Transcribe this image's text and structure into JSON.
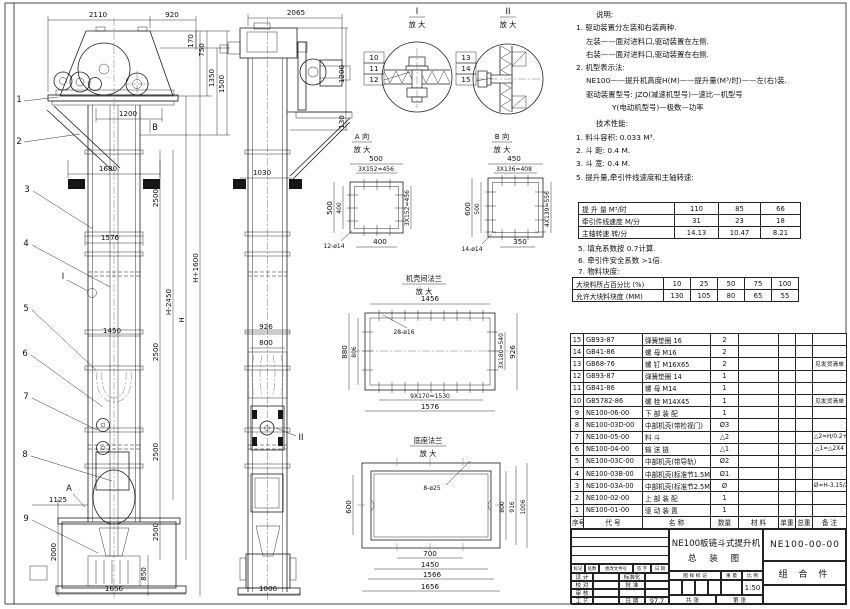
{
  "front": {
    "balloons": [
      "1",
      "2",
      "3",
      "4",
      "5",
      "6",
      "7",
      "8",
      "9"
    ],
    "detail_mark": "I",
    "arrow_a": "A",
    "arrow_b": "B",
    "d": {
      "w2110": "2110",
      "w920": "920",
      "v170": "170",
      "v750": "750",
      "v1350": "1350",
      "v1500": "1500",
      "w1200": "1200",
      "w1680": "1680",
      "p2500": "2500",
      "w1576": "1576",
      "hp": "H+1600",
      "hm": "H-2450",
      "h": "H",
      "w1450": "1450",
      "w1125": "1125",
      "v2000": "2000",
      "v850": "850",
      "w1656": "1656"
    }
  },
  "side": {
    "detail_mark": "II",
    "d": {
      "w2065": "2065",
      "v1200": "1200",
      "v130": "130",
      "w1030": "1030",
      "w926": "926",
      "w800": "800",
      "w1006": "1006"
    }
  },
  "details": {
    "i": {
      "title": "I",
      "sub": "放 大",
      "callouts": [
        "10",
        "11",
        "12"
      ]
    },
    "ii": {
      "title": "II",
      "sub": "放 大",
      "callouts": [
        "13",
        "14",
        "15"
      ]
    }
  },
  "viewA": {
    "title": "A 向",
    "sub": "放 大",
    "d": {
      "t1": "500",
      "t2": "3X152=456",
      "l1": "500",
      "l2": "400",
      "r1": "3X152=456",
      "b1": "400",
      "holes": "12-ø14"
    }
  },
  "viewB": {
    "title": "B 向",
    "sub": "放 大",
    "d": {
      "t1": "450",
      "t2": "3X136=408",
      "l1": "600",
      "l2": "500",
      "r1": "4X139=556",
      "b1": "350",
      "holes": "14-ø14"
    }
  },
  "flangeView": {
    "title": "机壳间法兰",
    "sub": "放 大",
    "d": {
      "t1": "1456",
      "holes": "28-ø16",
      "l1": "880",
      "l2": "806",
      "r1": "3X180=540",
      "r2": "926",
      "b1": "9X170=1530",
      "b2": "1576"
    }
  },
  "baseView": {
    "title": "底座法兰",
    "sub": "放 大",
    "d": {
      "holes": "8-ø25",
      "l1": "600",
      "r1": "800",
      "r2": "916",
      "r3": "1006",
      "b1": "700",
      "b2": "1450",
      "b3": "1566",
      "b4": "1656"
    }
  },
  "notes": {
    "lines": [
      "说明:",
      "1. 驱动装置分左装和右装两种.",
      "左装——面对进料口,驱动装置在左侧.",
      "右装——面对进料口,驱动装置在右侧.",
      "2. 机型表示法:",
      "NE100——提升机高度H(M)——提升量(M³/时)——左(右)装.",
      "驱动装置型号: JZQ(减速机型号)—速比—机型号",
      "Y(电动机型号)—极数—功率"
    ]
  },
  "tech": {
    "heading": "技术性能:",
    "lines": [
      "1. 料斗容积: 0.033 M³.",
      "2. 斗  距: 0.4 M.",
      "3. 斗  宽: 0.4 M.",
      "5. 提升量,牵引件线速度和主轴转速:"
    ],
    "more": [
      "5. 填充系数按 0.7计算.",
      "6. 牵引件安全系数 >1倍.",
      "7. 物料块度:"
    ]
  },
  "perf": {
    "rows": [
      [
        "提 升 量   M³/时",
        "110",
        "85",
        "66"
      ],
      [
        "牵引件线速度 M/分",
        "31",
        "23",
        "18"
      ],
      [
        "主轴转速  转/分",
        "14.13",
        "10.47",
        "8.21"
      ]
    ]
  },
  "lump": {
    "rows": [
      [
        "大块料所占百分比 (%)",
        "10",
        "25",
        "50",
        "75",
        "100"
      ],
      [
        "允许大块料块度 (MM)",
        "130",
        "105",
        "80",
        "65",
        "55"
      ]
    ]
  },
  "bom": {
    "headers": [
      "序号",
      "代  号",
      "名    称",
      "数量",
      "材  料",
      "单重",
      "总重",
      "备  注"
    ],
    "rows": [
      [
        "15",
        "GB93-87",
        "弹簧垫圈  16",
        "2",
        "",
        "",
        "",
        ""
      ],
      [
        "14",
        "GB41-86",
        "螺 母  M16",
        "2",
        "",
        "",
        "",
        ""
      ],
      [
        "13",
        "GB68-76",
        "螺 钉  M16X65",
        "2",
        "",
        "",
        "",
        "见发货清单"
      ],
      [
        "12",
        "GB93-87",
        "弹簧垫圈  14",
        "1",
        "",
        "",
        "",
        ""
      ],
      [
        "11",
        "GB41-86",
        "螺 母  M14",
        "1",
        "",
        "",
        "",
        ""
      ],
      [
        "10",
        "GB5782-86",
        "螺 栓  M14X45",
        "1",
        "",
        "",
        "",
        "见发货清单"
      ],
      [
        "9",
        "NE100-06-00",
        "下 部 装 配",
        "1",
        "",
        "",
        "",
        ""
      ],
      [
        "8",
        "NE100-03D-00",
        "中部机壳(带检视门)",
        "Ø3",
        "",
        "",
        "",
        ""
      ],
      [
        "7",
        "NE100-05-00",
        "料  斗",
        "△2",
        "",
        "",
        "",
        "△2=H/0.2+5.75"
      ],
      [
        "6",
        "NE100-04-00",
        "输 送 链",
        "△1",
        "",
        "",
        "",
        "△1=△2X4"
      ],
      [
        "5",
        "NE100-03C-00",
        "中部机壳(带导轨)",
        "Ø2",
        "",
        "",
        "",
        ""
      ],
      [
        "4",
        "NE100-03B-00",
        "中部机壳(标准节1.5M,1M)",
        "Ø1",
        "",
        "",
        "",
        ""
      ],
      [
        "3",
        "NE100-03A-00",
        "中部机壳(标准节2.5M)",
        "Ø",
        "",
        "",
        "",
        "Ø=H-3.15/2.5"
      ],
      [
        "2",
        "NE100-02-00",
        "上 部 装 配",
        "1",
        "",
        "",
        "",
        ""
      ],
      [
        "1",
        "NE100-01-00",
        "驱 动 装 置",
        "1",
        "",
        "",
        "",
        ""
      ]
    ]
  },
  "titleblock": {
    "title": "NE100板链斗式提升机",
    "subtitle": "总  装  图",
    "code": "NE100-00-00",
    "part_type": "组 合 件",
    "rev_headers": [
      "标记",
      "处数",
      "更改文件号",
      "签 字",
      "日 期"
    ],
    "roles": [
      [
        "设 计",
        "标准化"
      ],
      [
        "校 对",
        "批 准"
      ],
      [
        "审 核",
        ""
      ],
      [
        "工 艺",
        "日 期"
      ]
    ],
    "date": "97.7",
    "stamp_header": [
      "图 样 标 记",
      "重 量",
      "比 例"
    ],
    "scale": "1:50",
    "sheet_footer": [
      "共    张",
      "第    张"
    ]
  }
}
